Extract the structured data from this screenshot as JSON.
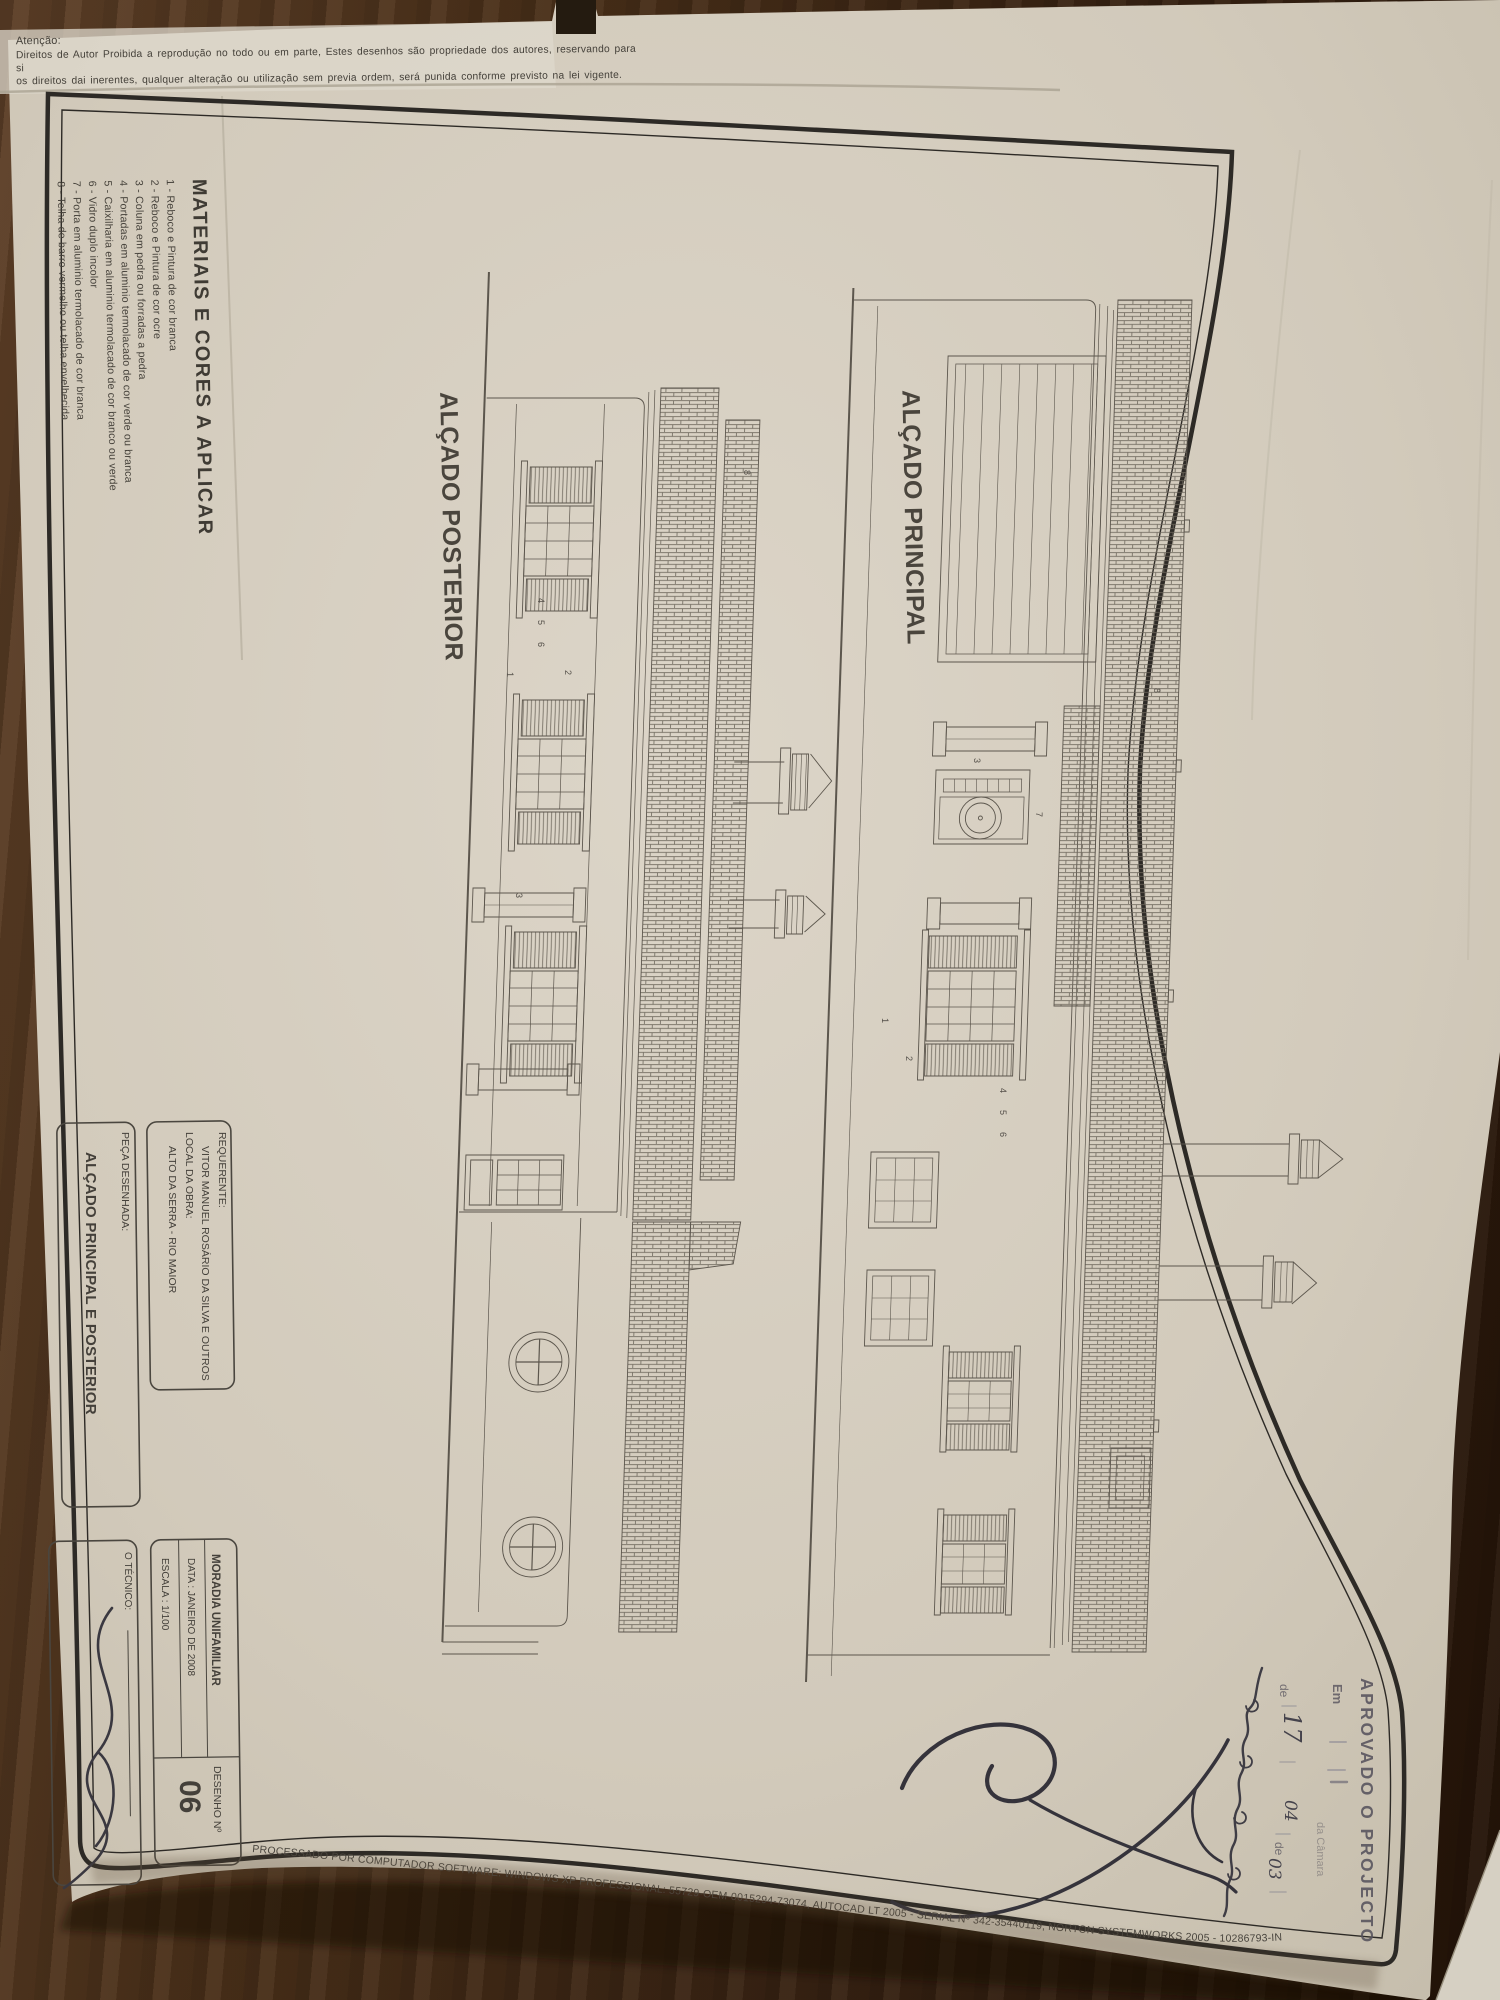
{
  "copyright_notice": {
    "title": "Atenção:",
    "line1": "Direitos de Autor Proibida a reprodução no todo ou em parte, Estes desenhos são propriedade dos autores, reservando para si",
    "line2": "os direitos dai inerentes, qualquer alteração ou utilização sem previa ordem, será punida conforme previsto na lei vigente."
  },
  "materials_legend": {
    "title": "MATERIAIS E CORES A APLICAR",
    "items": [
      "1 - Reboco e Pintura de cor branca",
      "2 - Reboco e Pintura de cor ocre",
      "3 - Coluna em pedra ou forradas a pedra",
      "4 - Portadas em aluminio termolacado de cor verde ou branca",
      "5 - Caixilharia em aluminio termolacado de cor branco ou verde",
      "6 - Vidro duplo incolor",
      "7 - Porta em aluminio termolacado de cor branca",
      "8 - Telha de barro vermelho ou telha envelhecida"
    ]
  },
  "drawings": {
    "posterior": {
      "label": "ALÇADO POSTERIOR",
      "annotations": [
        {
          "n": "1",
          "x": 505,
          "y": 672
        },
        {
          "n": "2",
          "x": 563,
          "y": 670
        },
        {
          "n": "4",
          "x": 536,
          "y": 598
        },
        {
          "n": "5",
          "x": 536,
          "y": 620
        },
        {
          "n": "6",
          "x": 536,
          "y": 642
        },
        {
          "n": "3",
          "x": 514,
          "y": 893
        },
        {
          "n": "8",
          "x": 742,
          "y": 470
        }
      ]
    },
    "principal": {
      "label": "ALÇADO PRINCIPAL",
      "annotations": [
        {
          "n": "7",
          "x": 1034,
          "y": 812
        },
        {
          "n": "3",
          "x": 972,
          "y": 758
        },
        {
          "n": "1",
          "x": 880,
          "y": 1018
        },
        {
          "n": "2",
          "x": 904,
          "y": 1056
        },
        {
          "n": "4",
          "x": 998,
          "y": 1088
        },
        {
          "n": "5",
          "x": 998,
          "y": 1110
        },
        {
          "n": "6",
          "x": 998,
          "y": 1132
        },
        {
          "n": "8",
          "x": 1152,
          "y": 688
        }
      ]
    }
  },
  "title_block": {
    "requerente_label": "REQUERENTE:",
    "requerente": "VITOR MANUEL ROSÁRIO DA SILVA E OUTROS",
    "local_label": "LOCAL DA OBRA:",
    "local": "ALTO DA SERRA - RIO MAIOR",
    "peca_label": "PEÇA DESENHADA:",
    "peca": "ALÇADO PRINCIPAL E POSTERIOR",
    "projecto": "MORADIA UNIFAMILIAR",
    "data": "DATA : JANEIRO DE 2008",
    "escala": "ESCALA : 1/100",
    "desenho_label": "DESENHO  Nº",
    "desenho_numero": "06",
    "tecnico_label": "O TÉCNICO:"
  },
  "approval_stamp": {
    "line1": "APROVADO O PROJECTO",
    "em_label": "Em",
    "camara_text": "da Câmara",
    "de_label_1": "de",
    "de_label_2": "de",
    "handwritten_day": "17",
    "handwritten_month": "04",
    "handwritten_year": "03"
  },
  "plot_stamp": "PROCESSADO POR COMPUTADOR SOFTWARE: WINDOWS XP PROFESSIONAL: 55729-OEM-0015294-73074, AUTOCAD LT 2005 - SERIAL Nº 342-35440119, NORTON SYSTEMWORKS 2005 - 10286793-IN",
  "colors": {
    "wood": "#43301c",
    "paper": "#d7d0c3",
    "ink": "#55504a",
    "frame": "#2d2a26",
    "stamp": "#57535d",
    "pen": "#3a3840"
  }
}
